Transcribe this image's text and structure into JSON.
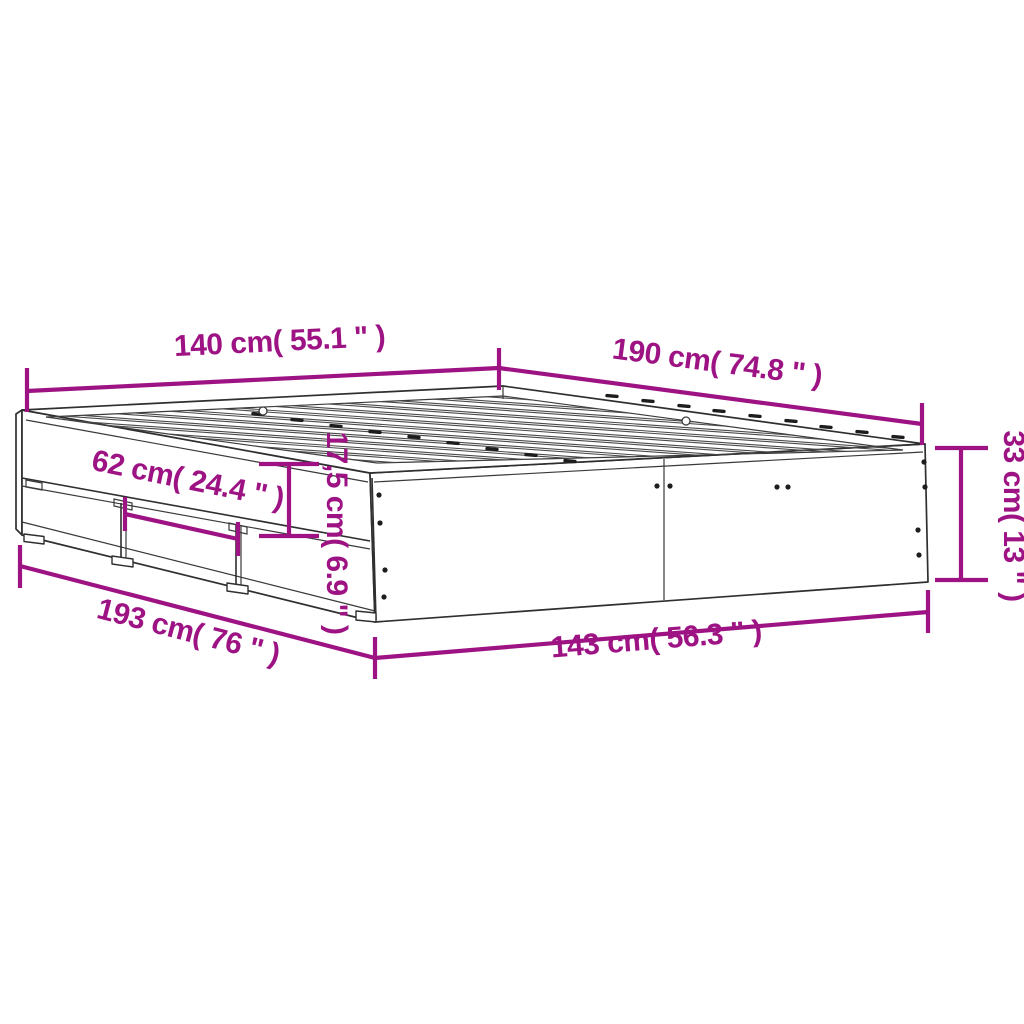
{
  "diagram": {
    "type": "product-dimension-diagram",
    "subject": "bed-frame-with-drawers",
    "accent_color": "#9E1384",
    "line_color": "#2F2F2F",
    "background_color": "#FFFFFF",
    "dimensions": [
      {
        "id": "top-width",
        "label": "140 cm( 55.1 \" )"
      },
      {
        "id": "top-length",
        "label": "190 cm( 74.8 \" )"
      },
      {
        "id": "side-height",
        "label": "33 cm( 13 \" )"
      },
      {
        "id": "drawer-width",
        "label": "62 cm( 24.4 \" )"
      },
      {
        "id": "rail-height",
        "label": "17,5 cm( 6.9 \" )"
      },
      {
        "id": "bottom-length",
        "label": "193 cm( 76 \" )"
      },
      {
        "id": "bottom-width",
        "label": "143 cm( 56.3 \" )"
      }
    ]
  }
}
